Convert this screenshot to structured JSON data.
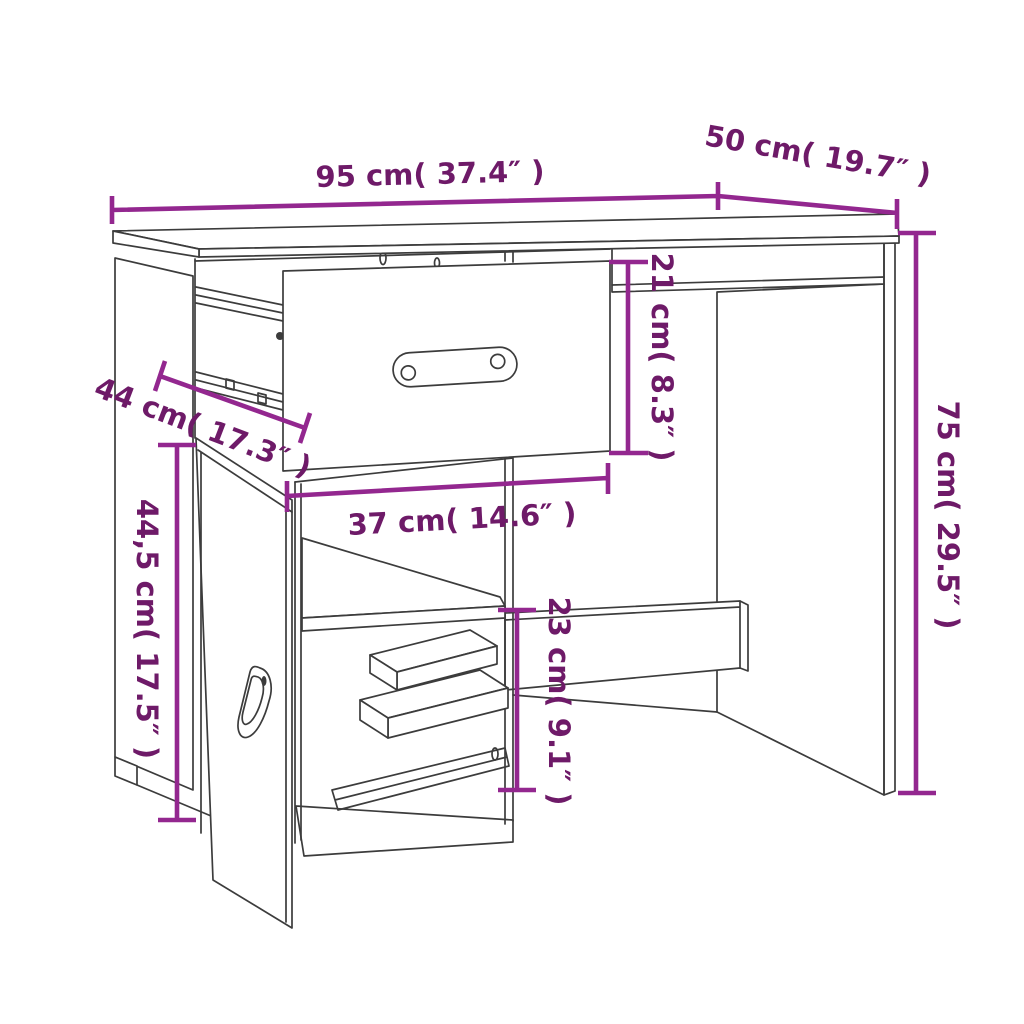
{
  "diagram": {
    "type": "product-dimension-diagram",
    "subject": "desk with drawer, cabinet door and open shelves",
    "dimensions": [
      {
        "id": "width",
        "label": "95 cm( 37.4″ )"
      },
      {
        "id": "depth",
        "label": "50 cm( 19.7″ )"
      },
      {
        "id": "height",
        "label": "75 cm( 29.5″ )"
      },
      {
        "id": "drawer-height",
        "label": "21 cm( 8.3″ )"
      },
      {
        "id": "side-depth",
        "label": "44 cm( 17.3″ )"
      },
      {
        "id": "drawer-width",
        "label": "37 cm( 14.6″ )"
      },
      {
        "id": "door-height",
        "label": "44,5 cm( 17.5″ )"
      },
      {
        "id": "compartment-height",
        "label": "23 cm( 9.1″ )"
      }
    ],
    "colors": {
      "dimension_line": "#93278F",
      "dimension_text": "#6E1A68",
      "artwork_line": "#3C3C3C",
      "background": "#FFFFFF"
    }
  }
}
